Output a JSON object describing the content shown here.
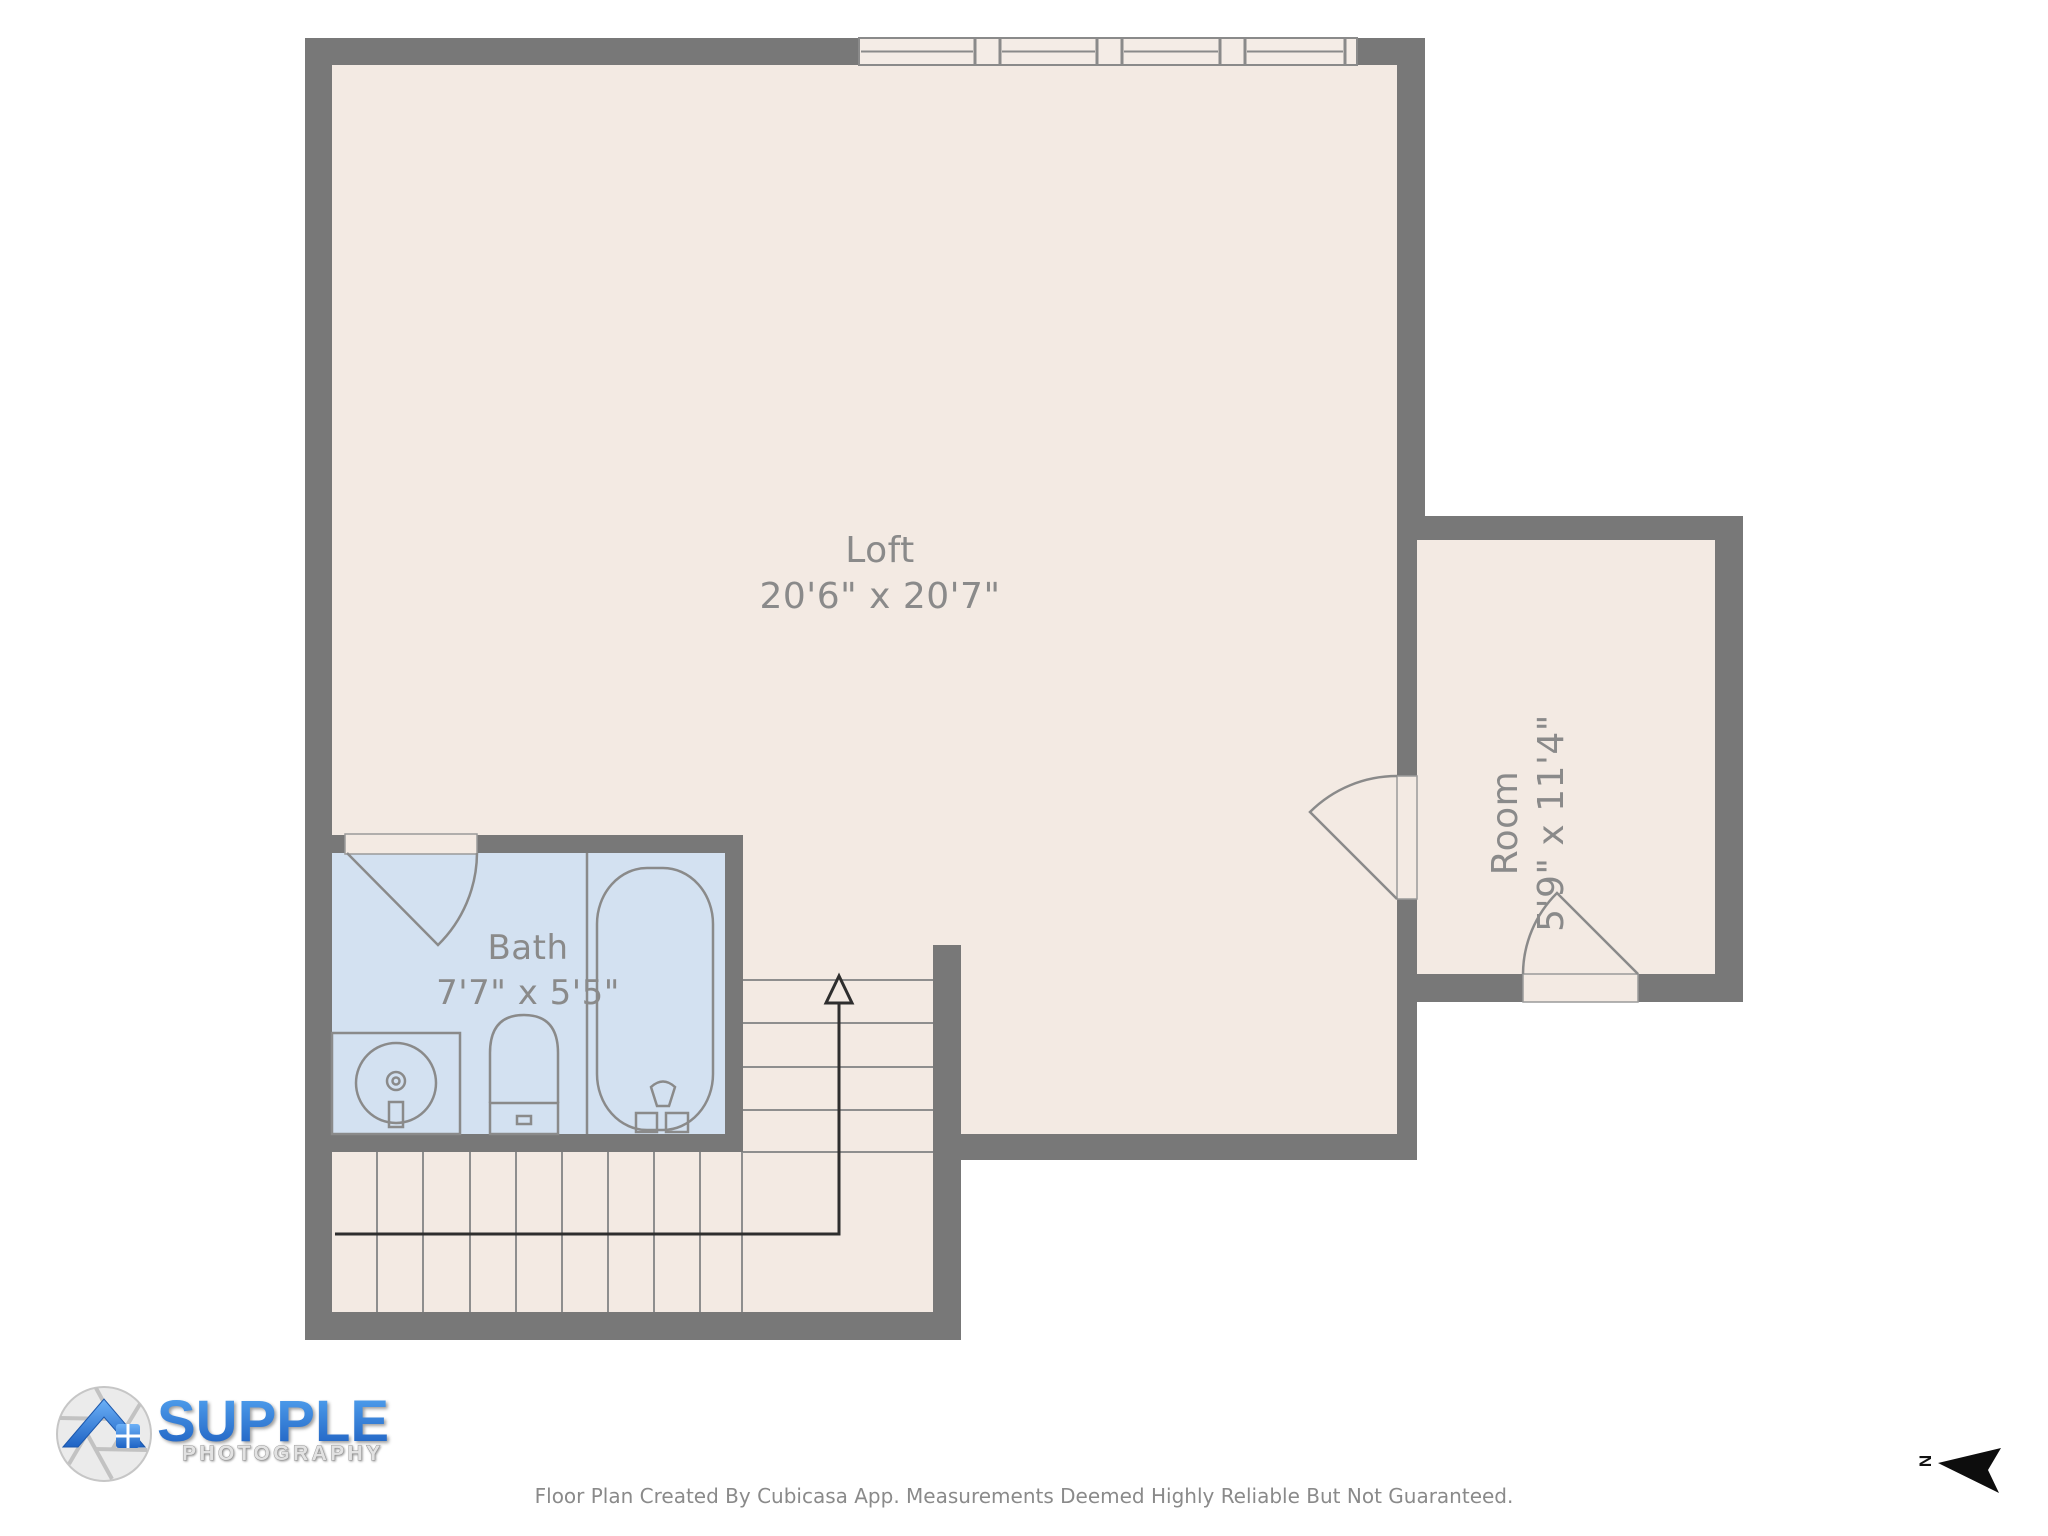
{
  "floor_plan": {
    "rooms": [
      {
        "id": "loft",
        "name": "Loft",
        "dimensions": "20'6\" x 20'7\""
      },
      {
        "id": "bath",
        "name": "Bath",
        "dimensions": "7'7\" x 5'5\""
      },
      {
        "id": "room",
        "name": "Room",
        "dimensions": "5'9\" x 11'4\""
      }
    ],
    "colors": {
      "wall": "#787878",
      "floor": "#f3eae3",
      "bath_floor": "#d3e1f1",
      "fixture_line": "#8a8a8a",
      "label_text": "#8a8a8a",
      "walk_line": "#2e2e2e",
      "window_pane": "#f4ece6"
    }
  },
  "branding": {
    "logo_title": "SUPPLE",
    "logo_subtitle": "PHOTOGRAPHY",
    "logo_blue": "#2e7fe0"
  },
  "footer": {
    "text": "Floor Plan Created By Cubicasa App. Measurements Deemed Highly Reliable But Not Guaranteed."
  },
  "compass": {
    "label": "N"
  }
}
